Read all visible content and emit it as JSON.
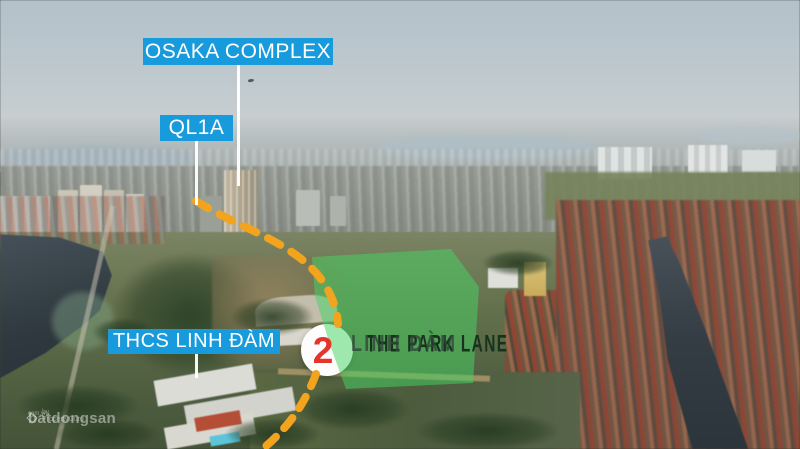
{
  "annotations": {
    "osaka_label": "OSAKA COMPLEX",
    "highway_label": "QL1A",
    "school_label": "THCS LINH ĐÀM",
    "marker_number": "2",
    "project_title": "THE PARK LANE",
    "project_subtitle": "LINH ĐÀM"
  },
  "watermark": {
    "brand": "batdongsan",
    "domain": "com.vn",
    "byline": "by PropertyGuru"
  },
  "colors": {
    "label_background": "#189BDC",
    "label_text": "#FFFFFF",
    "route_dash": "#F2A41E",
    "land_highlight": "rgba(70,210,100,0.52)",
    "marker_circle": "#FFFFFF",
    "marker_number": "#E4342B",
    "project_title_text": "#17321D",
    "project_subtitle_text": "rgba(48,70,56,0.8)"
  }
}
